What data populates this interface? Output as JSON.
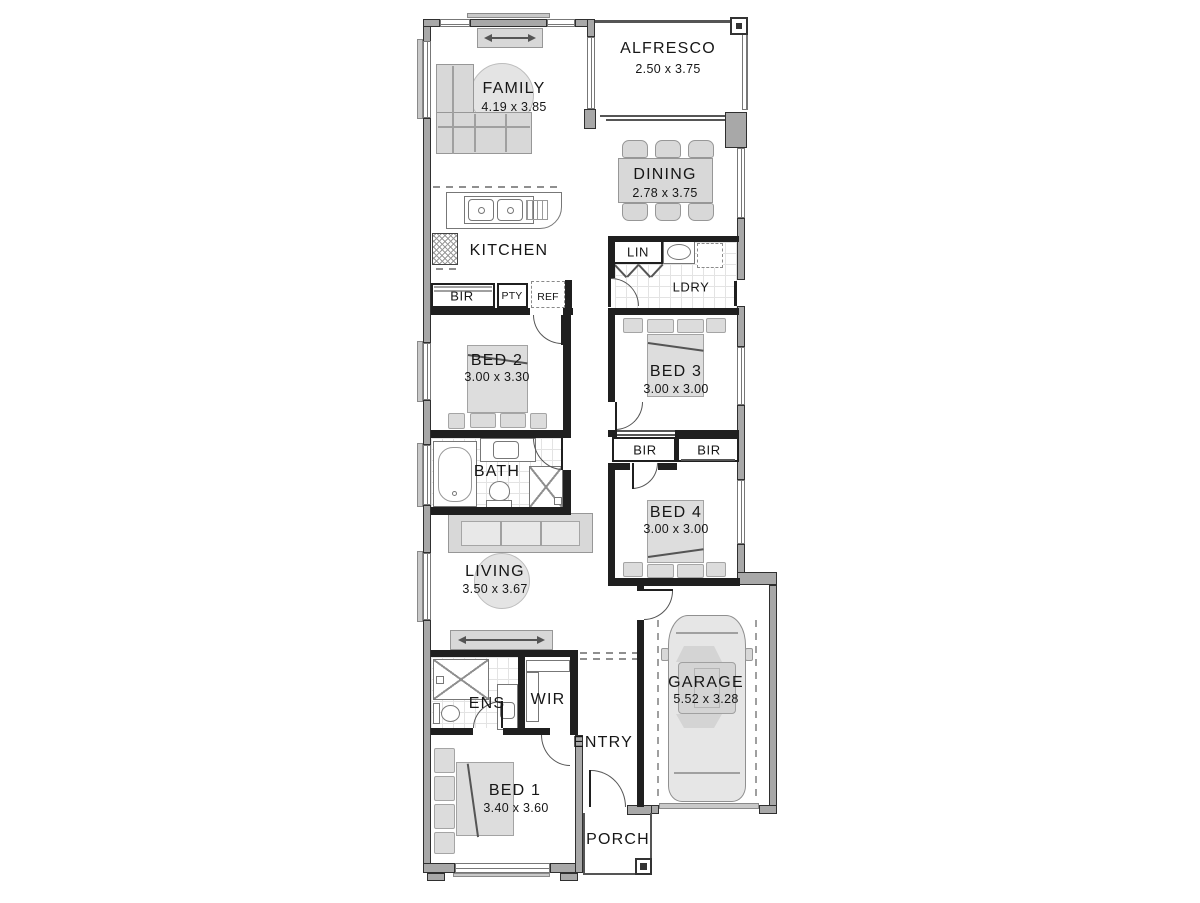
{
  "plan": {
    "rooms": {
      "family": {
        "label": "FAMILY",
        "dims": "4.19 x 3.85"
      },
      "alfresco": {
        "label": "ALFRESCO",
        "dims": "2.50 x 3.75"
      },
      "dining": {
        "label": "DINING",
        "dims": "2.78 x 3.75"
      },
      "kitchen": {
        "label": "KITCHEN"
      },
      "ldry": {
        "label": "LDRY"
      },
      "bed2": {
        "label": "BED 2",
        "dims": "3.00 x 3.30"
      },
      "bed3": {
        "label": "BED 3",
        "dims": "3.00 x 3.00"
      },
      "bath": {
        "label": "BATH"
      },
      "bed4": {
        "label": "BED 4",
        "dims": "3.00 x 3.00"
      },
      "living": {
        "label": "LIVING",
        "dims": "3.50 x 3.67"
      },
      "garage": {
        "label": "GARAGE",
        "dims": "5.52 x 3.28"
      },
      "ens": {
        "label": "ENS"
      },
      "wir": {
        "label": "WIR"
      },
      "entry": {
        "label": "ENTRY"
      },
      "bed1": {
        "label": "BED 1",
        "dims": "3.40 x 3.60"
      },
      "porch": {
        "label": "PORCH"
      }
    },
    "closets": {
      "lin": "LIN",
      "bir_kitchen": "BIR",
      "pty": "PTY",
      "ref": "REF",
      "bir_bed3": "BIR",
      "bir_bed4": "BIR"
    },
    "colors": {
      "exterior_wall": "#a8a8a8",
      "interior_wall": "#1f1f1f",
      "furniture": "#d8d8d8",
      "text": "#161616"
    }
  }
}
